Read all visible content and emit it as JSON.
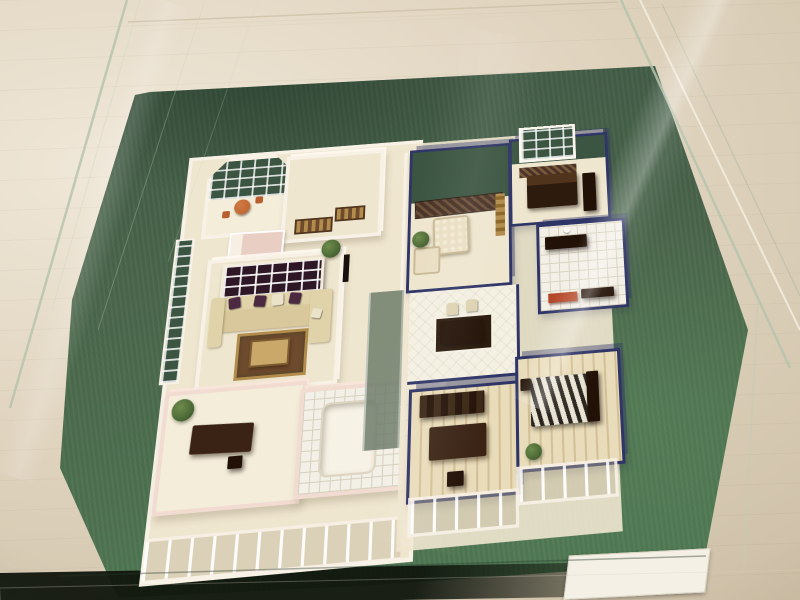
{
  "scene": {
    "description": "Photograph of a miniature architectural scale model of an apartment floor plan with furniture, displayed under a clear glass case on a green turf base",
    "display_case": "clear glass box with visible corner edges and reflections",
    "base": "green artificial turf board with a blank white plaque card at the front right",
    "units": [
      {
        "name": "west-unit",
        "wall_style": "white and pink solid miniature walls",
        "rooms": [
          "bay-window-balcony",
          "north-bedroom",
          "west-living-room",
          "southwest-study",
          "west-bathroom",
          "west-facade-windows"
        ]
      },
      {
        "name": "east-unit",
        "wall_style": "navy blue wire-frame glazed walls",
        "rooms": [
          "east-living-room",
          "northeast-bedroom",
          "east-bathroom",
          "entry-hall-dining",
          "kitchen-nook",
          "east-study",
          "southeast-bedroom",
          "southeast-balcony"
        ]
      }
    ],
    "furniture": [
      "patio-table",
      "patio-chairs",
      "pink-bed",
      "lattice-screen",
      "cream-sectional-sofa",
      "purple-pillows",
      "coffee-table",
      "area-rugs",
      "study-desks",
      "bathtub",
      "tapestry-rug",
      "floral-armchairs",
      "gold-console",
      "dark-bed",
      "wardrobe",
      "bath-vanity",
      "white-vase",
      "dining-table",
      "dining-chairs",
      "red-kitchen-counter",
      "bookshelf",
      "striped-bed",
      "potted-plants"
    ],
    "staircase": "white straight-run stairs between the two units",
    "plaque_text": ""
  },
  "palette": {
    "bg_light": "#f0e8d9",
    "bg_mid": "#e0d4bf",
    "bg_shade": "#cdbfa6",
    "turf": "#486349",
    "turf_dark": "#3c5542",
    "turf_light": "#4e7852",
    "navy": "#2f3566",
    "wall_white": "#f8f1e6",
    "wall_pink": "#f2dcd2",
    "floor": "#efe6cf",
    "floor_alt": "#f4edda",
    "tile": "#f3f0e7",
    "tile_line": "#d7d1bf",
    "plank": "#e9dcba",
    "plank_line": "#d3c096",
    "wood": "#3a2314",
    "wood_deep": "#221106",
    "sofa": "#e1d3a9",
    "pillow": "#4b2a41",
    "pillow_light": "#eae3c9",
    "rug_gold": "#b28c4c",
    "rug_brown": "#6f4b2e",
    "tapestry": "#493227",
    "patio": "#b95f2e",
    "plant": "#4d6a37",
    "counter_red": "#b54729",
    "bed_pink": "#e9cfc3",
    "stripe_dark": "#2a261f",
    "stripe_light": "#e9e3d3",
    "glass_line": "#b7c4ae",
    "glass_hi": "#f4f0e4",
    "glass_soft": "#a9b8a2",
    "frame_line": "#c8bca3",
    "plaque": "#f4f0e5"
  }
}
